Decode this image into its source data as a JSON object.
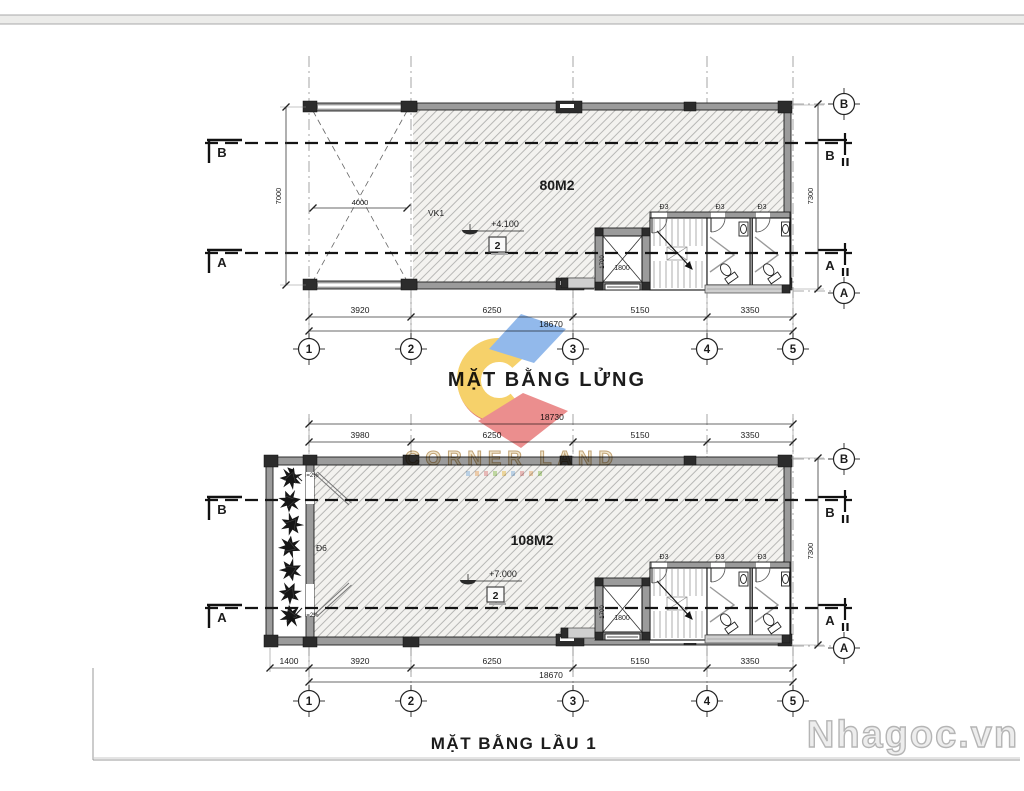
{
  "sheet": {
    "brand_watermark": "CORNER LAND",
    "site_watermark": "Nhagoc.vn"
  },
  "mezzanine": {
    "title": "MẶT BẰNG LỬNG",
    "area": "80M2",
    "level": "+4.100",
    "level_box": "2",
    "void_dim": "4000",
    "vk_label": "VK1",
    "door_label": "Đ3",
    "lift_width": "1800",
    "lift_depth": "1700",
    "dims_bottom": [
      "3920",
      "6250",
      "5150",
      "3350"
    ],
    "total_bottom": "18670",
    "dim_left": "7000",
    "dim_right": "7300",
    "grid_cols": [
      "1",
      "2",
      "3",
      "4",
      "5"
    ],
    "row_top": "B",
    "row_bottom": "A"
  },
  "floor1": {
    "title": "MẶT BẰNG LẦU 1",
    "area": "108M2",
    "level": "+7.000",
    "level_box": "2",
    "door_label": "Đ3",
    "balcony_door_label": "Đ6",
    "slope_label": "i=2%",
    "lift_width": "1800",
    "lift_depth": "1700",
    "dims_top": [
      "3980",
      "6250",
      "5150",
      "3350"
    ],
    "total_top": "18730",
    "dims_bottom": [
      "1400",
      "3920",
      "6250",
      "5150",
      "3350"
    ],
    "total_bottom": "18670",
    "dim_right": "7300",
    "grid_cols": [
      "1",
      "2",
      "3",
      "4",
      "5"
    ],
    "row_top": "B",
    "row_bottom": "A"
  }
}
